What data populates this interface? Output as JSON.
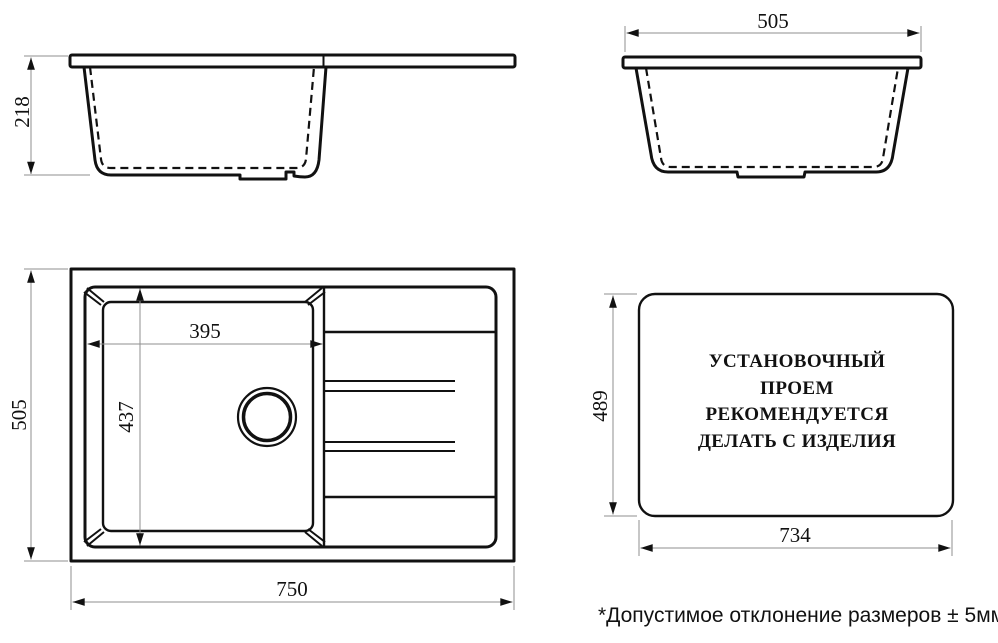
{
  "drawing": {
    "side_view": {
      "depth_label": "218"
    },
    "end_view": {
      "width_label": "505"
    },
    "plan_view": {
      "height_label": "505",
      "width_label": "750",
      "bowl_width_label": "395",
      "bowl_length_label": "437"
    },
    "cutout_view": {
      "height_label": "489",
      "width_label": "734",
      "lines": [
        "УСТАНОВОЧНЫЙ",
        "ПРОЕМ",
        "РЕКОМЕНДУЕТСЯ",
        "ДЕЛАТЬ С ИЗДЕЛИЯ"
      ]
    },
    "footnote": "*Допустимое отклонение размеров ± 5мм"
  },
  "colors": {
    "line": "#111111",
    "dim_line": "#8f8f8f",
    "text": "#111111",
    "background": "#ffffff"
  }
}
